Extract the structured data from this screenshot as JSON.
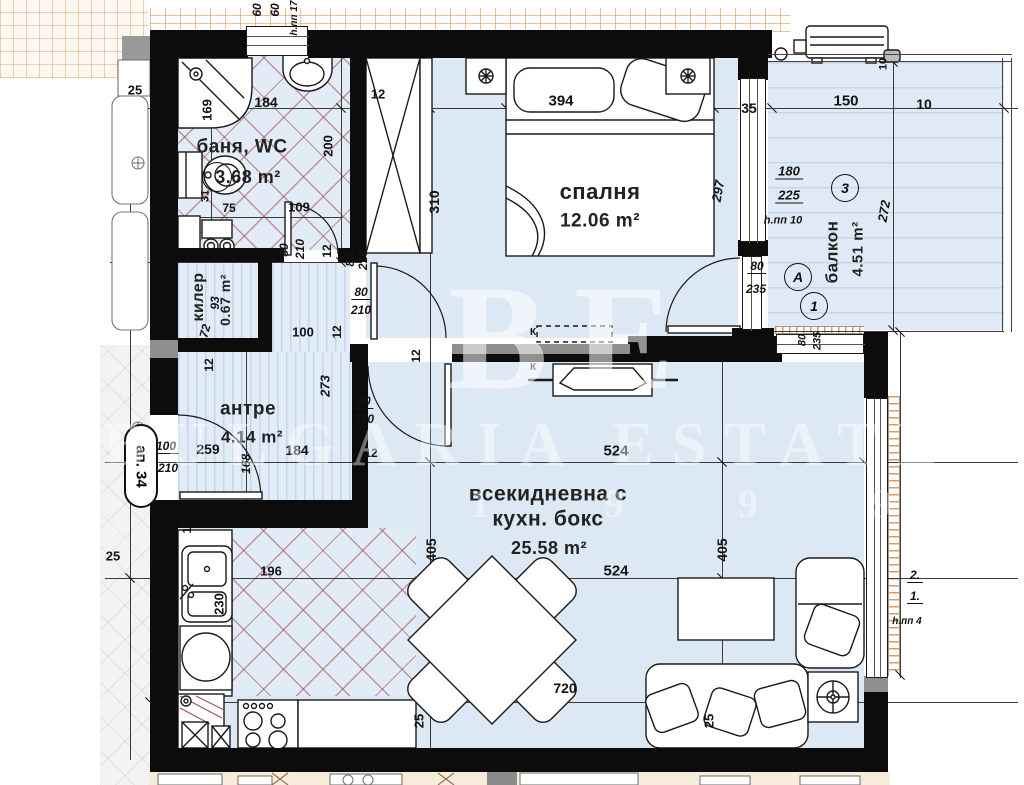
{
  "plan": {
    "apartment_label": "ап. 34",
    "watermark": {
      "monogram": "BE",
      "text": "BULGARIA ESTATE",
      "numbers": "1 9 9 9"
    },
    "rooms": [
      {
        "id": "bath",
        "name": "баня, WC",
        "area": "3.68 m²",
        "nx": 242,
        "ny": 147,
        "nfs": 19,
        "ax": 248,
        "ay": 177,
        "afs": 18
      },
      {
        "id": "closet",
        "name": "килер",
        "area": "0.67 m²",
        "nx": 199,
        "ny": 297,
        "nr": -90,
        "nfs": 16,
        "ax": 225,
        "ay": 300,
        "ar": -90,
        "afs": 14
      },
      {
        "id": "hall",
        "name": "антре",
        "area": "4.14 m²",
        "nx": 248,
        "ny": 409,
        "nfs": 19,
        "ax": 252,
        "ay": 437,
        "afs": 17
      },
      {
        "id": "bedroom",
        "name": "спалня",
        "area": "12.06 m²",
        "nx": 600,
        "ny": 192,
        "nfs": 22,
        "ax": 600,
        "ay": 221,
        "afs": 19
      },
      {
        "id": "living",
        "name": "всекидневна с",
        "name2": "кухн. бокс",
        "n2x": 548,
        "n2y": 519,
        "area": "25.58 m²",
        "nx": 548,
        "ny": 494,
        "nfs": 21,
        "ax": 549,
        "ay": 548,
        "afs": 18
      },
      {
        "id": "balcony",
        "name": "балкон",
        "area": "4.51 m²",
        "nx": 832,
        "ny": 252,
        "nr": -90,
        "nfs": 17,
        "ax": 858,
        "ay": 249,
        "ar": -90,
        "afs": 15
      }
    ],
    "markers": [
      {
        "label": "3",
        "x": 845,
        "y": 188
      },
      {
        "label": "A",
        "x": 798,
        "y": 277
      },
      {
        "label": "1",
        "x": 814,
        "y": 306
      },
      {
        "label": "",
        "x": 217,
        "y": 177,
        "d": 30
      }
    ],
    "dims": [
      {
        "t": "60",
        "x": 257,
        "y": 10,
        "r": -90,
        "it": 1,
        "fs": 12
      },
      {
        "t": "60",
        "x": 275,
        "y": 10,
        "r": -90,
        "it": 1,
        "fs": 12
      },
      {
        "t": "h.пп 17",
        "x": 295,
        "y": 18,
        "r": -90,
        "it": 1,
        "fs": 10
      },
      {
        "t": "25",
        "x": 135,
        "y": 90
      },
      {
        "t": "184",
        "x": 266,
        "y": 102,
        "fs": 14
      },
      {
        "t": "169",
        "x": 207,
        "y": 110,
        "r": -90
      },
      {
        "t": "12",
        "x": 378,
        "y": 94
      },
      {
        "t": "394",
        "x": 561,
        "y": 101,
        "fs": 15
      },
      {
        "t": "35",
        "x": 749,
        "y": 108,
        "fs": 14
      },
      {
        "t": "150",
        "x": 846,
        "y": 101,
        "fs": 15
      },
      {
        "t": "10",
        "x": 924,
        "y": 104,
        "fs": 14
      },
      {
        "t": "10",
        "x": 884,
        "y": 64,
        "r": -90,
        "fs": 11
      },
      {
        "t": "200",
        "x": 328,
        "y": 146,
        "r": -90
      },
      {
        "t": "310",
        "x": 434,
        "y": 202,
        "r": -90,
        "fs": 14
      },
      {
        "t": "297",
        "x": 718,
        "y": 191,
        "r": -80,
        "it": 1
      },
      {
        "t": "180",
        "x": 789,
        "y": 172,
        "it": 1,
        "fr": 1
      },
      {
        "t": "225",
        "x": 789,
        "y": 196,
        "it": 1,
        "fr": 1
      },
      {
        "t": "h.пп 10",
        "x": 783,
        "y": 221,
        "it": 1,
        "fs": 11
      },
      {
        "t": "272",
        "x": 884,
        "y": 211,
        "r": -80,
        "it": 1
      },
      {
        "t": "31",
        "x": 206,
        "y": 196,
        "r": -90,
        "fs": 11
      },
      {
        "t": "75",
        "x": 229,
        "y": 208,
        "fs": 12
      },
      {
        "t": "109",
        "x": 299,
        "y": 207
      },
      {
        "t": "80",
        "x": 284,
        "y": 250,
        "r": -90,
        "it": 1,
        "fs": 12
      },
      {
        "t": "210",
        "x": 300,
        "y": 249,
        "r": -90,
        "it": 1,
        "fs": 12
      },
      {
        "t": "12",
        "x": 327,
        "y": 251,
        "r": -90,
        "fs": 12
      },
      {
        "t": "80",
        "x": 350,
        "y": 260,
        "r": -90,
        "it": 1,
        "fs": 12
      },
      {
        "t": "210",
        "x": 363,
        "y": 260,
        "r": -90,
        "it": 1,
        "fs": 12
      },
      {
        "t": "80",
        "x": 361,
        "y": 293,
        "it": 1,
        "fs": 12,
        "fr": 1
      },
      {
        "t": "210",
        "x": 361,
        "y": 310,
        "it": 1,
        "fs": 12
      },
      {
        "t": "12",
        "x": 416,
        "y": 356,
        "r": -90,
        "fs": 12
      },
      {
        "t": "90",
        "x": 364,
        "y": 402,
        "it": 1,
        "fs": 12,
        "fr": 1
      },
      {
        "t": "210",
        "x": 364,
        "y": 419,
        "it": 1,
        "fs": 12
      },
      {
        "t": "93",
        "x": 215,
        "y": 303,
        "r": -90,
        "it": 1,
        "fs": 12
      },
      {
        "t": "72",
        "x": 205,
        "y": 331,
        "r": -75,
        "it": 1,
        "fs": 12
      },
      {
        "t": "12",
        "x": 209,
        "y": 365,
        "r": -90,
        "fs": 12
      },
      {
        "t": "100",
        "x": 303,
        "y": 332
      },
      {
        "t": "12",
        "x": 337,
        "y": 332,
        "r": -90,
        "fs": 12
      },
      {
        "t": "273",
        "x": 325,
        "y": 386,
        "r": -90,
        "it": 1
      },
      {
        "t": "80",
        "x": 757,
        "y": 267,
        "it": 1,
        "fs": 12,
        "fr": 1
      },
      {
        "t": "235",
        "x": 756,
        "y": 289,
        "it": 1,
        "fs": 12
      },
      {
        "t": "80",
        "x": 803,
        "y": 340,
        "r": -90,
        "it": 1,
        "fs": 11
      },
      {
        "t": "235",
        "x": 818,
        "y": 341,
        "r": -90,
        "it": 1,
        "fs": 11
      },
      {
        "t": "100",
        "x": 166,
        "y": 447,
        "it": 1,
        "fs": 12,
        "fr": 1
      },
      {
        "t": "210",
        "x": 168,
        "y": 468,
        "it": 1,
        "fs": 12
      },
      {
        "t": "259",
        "x": 208,
        "y": 449,
        "fs": 14
      },
      {
        "t": "168",
        "x": 246,
        "y": 464,
        "r": -90,
        "it": 1,
        "fs": 12
      },
      {
        "t": "184",
        "x": 297,
        "y": 450,
        "fs": 14
      },
      {
        "t": "12",
        "x": 371,
        "y": 453,
        "fs": 12
      },
      {
        "t": "524",
        "x": 616,
        "y": 451,
        "fs": 15
      },
      {
        "t": "405",
        "x": 431,
        "y": 550,
        "r": -90,
        "fs": 14
      },
      {
        "t": "405",
        "x": 722,
        "y": 550,
        "r": -90,
        "fs": 14
      },
      {
        "t": "196",
        "x": 271,
        "y": 571
      },
      {
        "t": "524",
        "x": 616,
        "y": 571,
        "fs": 15
      },
      {
        "t": "25",
        "x": 113,
        "y": 556
      },
      {
        "t": "12",
        "x": 187,
        "y": 527,
        "r": -90,
        "fs": 12
      },
      {
        "t": "230",
        "x": 219,
        "y": 604,
        "r": -90
      },
      {
        "t": "720",
        "x": 565,
        "y": 688,
        "fs": 14
      },
      {
        "t": "25",
        "x": 419,
        "y": 721,
        "r": -90
      },
      {
        "t": "25",
        "x": 709,
        "y": 721,
        "r": -90
      },
      {
        "t": "2.",
        "x": 915,
        "y": 576,
        "it": 1,
        "fs": 12,
        "fr": 1
      },
      {
        "t": "1.",
        "x": 915,
        "y": 597,
        "it": 1,
        "fs": 12,
        "fr": 1
      },
      {
        "t": "h.пп 4",
        "x": 907,
        "y": 622,
        "it": 1,
        "fs": 10
      },
      {
        "t": "К",
        "x": 533,
        "y": 333,
        "fs": 10
      },
      {
        "t": "К",
        "x": 533,
        "y": 368,
        "fs": 10
      }
    ]
  }
}
